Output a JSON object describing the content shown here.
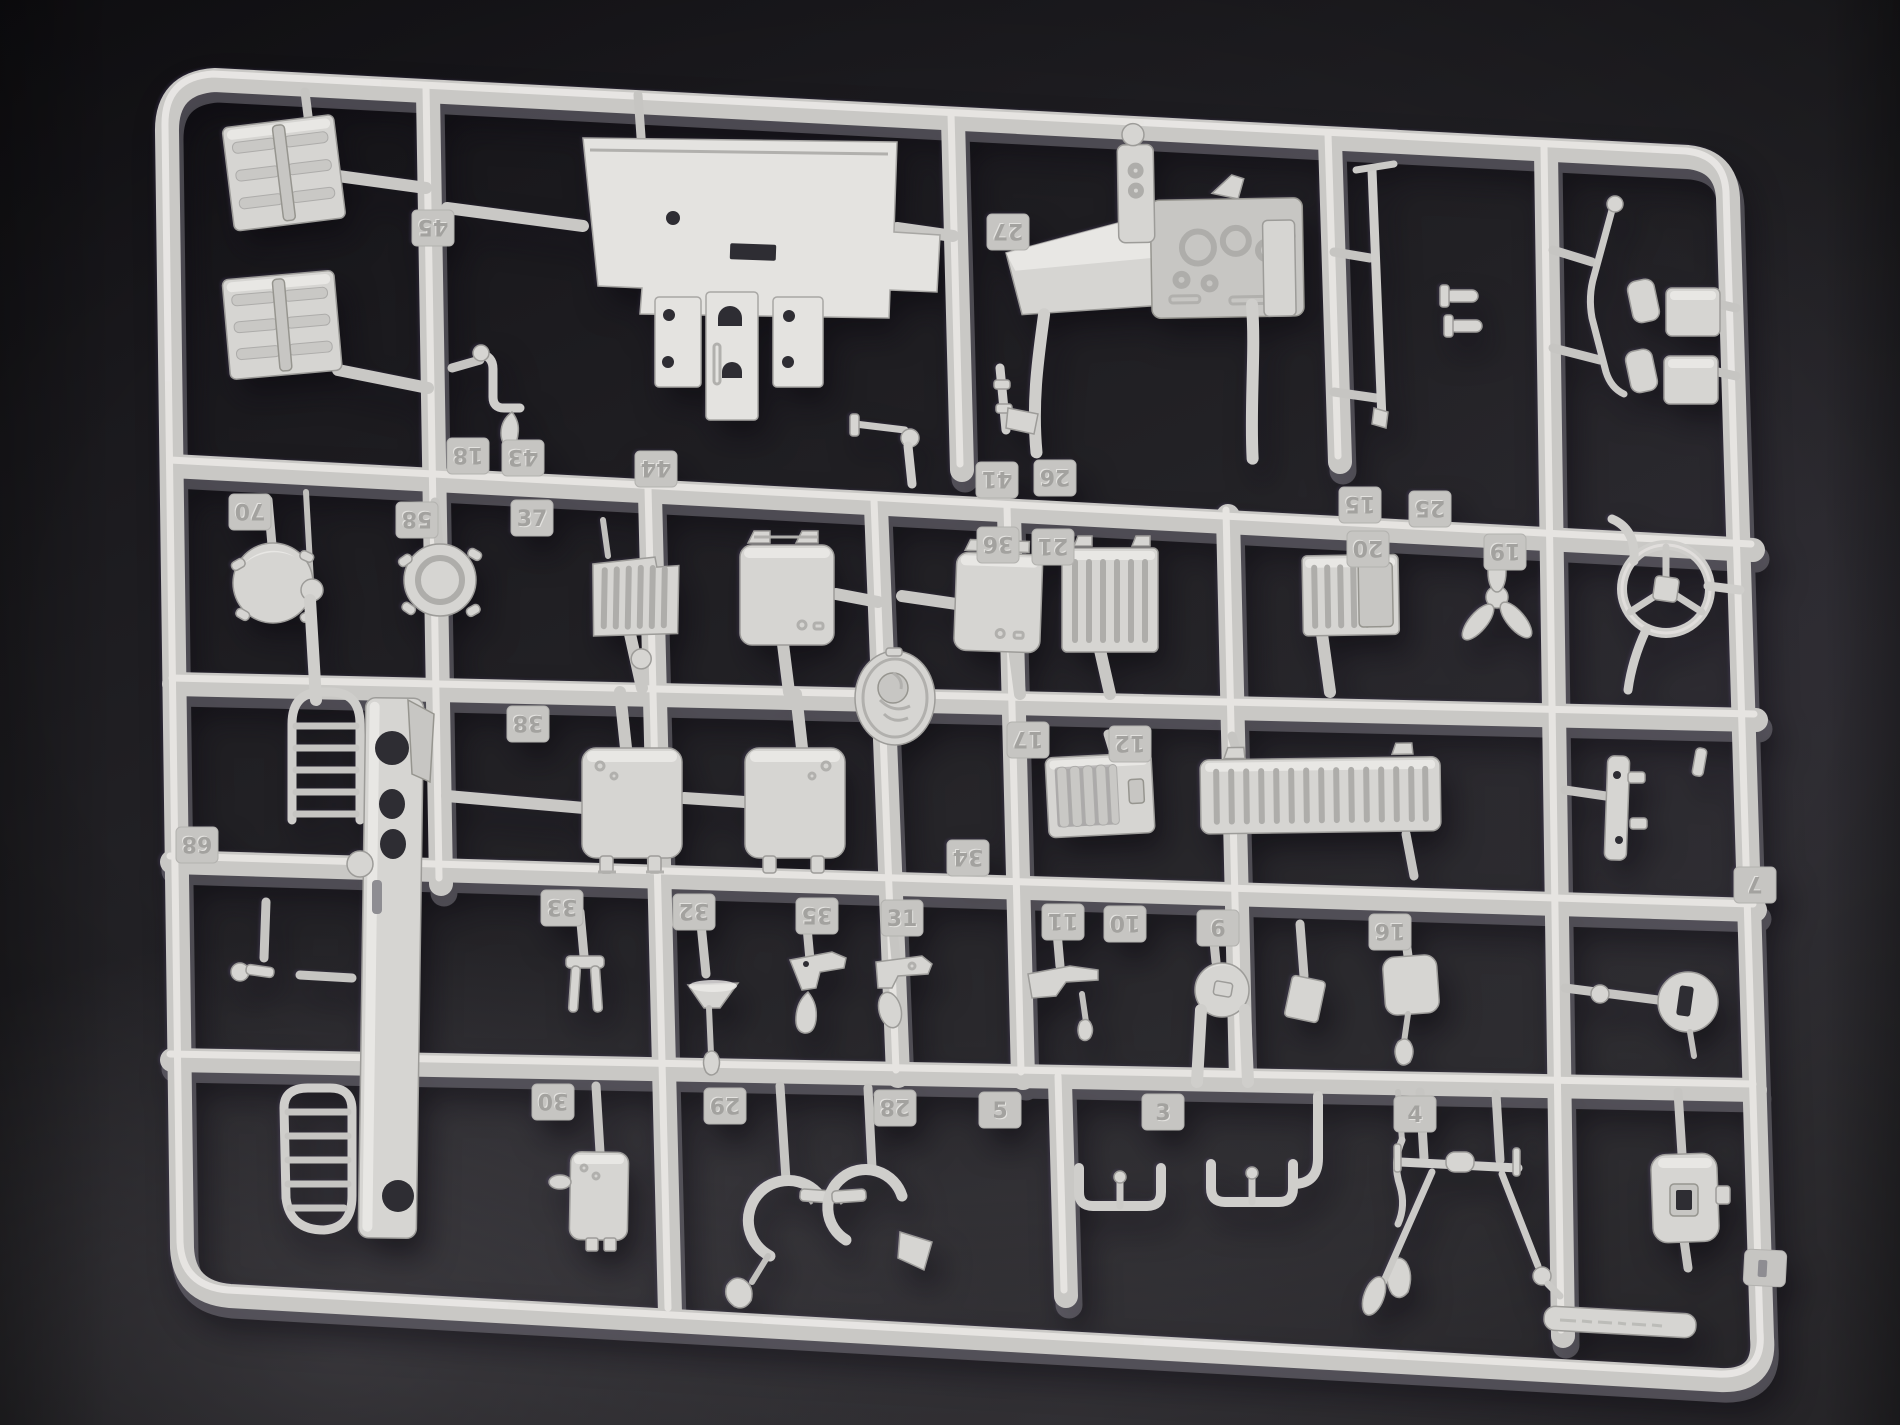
{
  "colors": {
    "background_dark": "#1d1c20",
    "background_light": "#3a383d",
    "plastic_base": "#c9c8c5",
    "plastic_highlight": "#eceae7",
    "plastic_shadow": "#807e86",
    "part_face": "#d6d5d2",
    "tag_face": "#c6c5c2",
    "hole_dark": "#2e2d33"
  },
  "sprue": {
    "material_color_name": "light-gray plastic",
    "part_number_tags": [
      {
        "label": "45",
        "x": 433,
        "y": 228,
        "rotated": true
      },
      {
        "label": "27",
        "x": 1008,
        "y": 232,
        "rotated": true
      },
      {
        "label": "18",
        "x": 468,
        "y": 456,
        "rotated": true
      },
      {
        "label": "43",
        "x": 523,
        "y": 458,
        "rotated": true
      },
      {
        "label": "44",
        "x": 656,
        "y": 469,
        "rotated": true
      },
      {
        "label": "41",
        "x": 997,
        "y": 480,
        "rotated": true
      },
      {
        "label": "26",
        "x": 1055,
        "y": 478,
        "rotated": true
      },
      {
        "label": "36",
        "x": 998,
        "y": 545,
        "rotated": true
      },
      {
        "label": "21",
        "x": 1053,
        "y": 547,
        "rotated": true
      },
      {
        "label": "15",
        "x": 1360,
        "y": 505,
        "rotated": true
      },
      {
        "label": "25",
        "x": 1430,
        "y": 509,
        "rotated": true
      },
      {
        "label": "20",
        "x": 1368,
        "y": 549,
        "rotated": true
      },
      {
        "label": "19",
        "x": 1505,
        "y": 552,
        "rotated": true
      },
      {
        "label": "70",
        "x": 250,
        "y": 512,
        "rotated": true
      },
      {
        "label": "58",
        "x": 417,
        "y": 520,
        "rotated": true
      },
      {
        "label": "37",
        "x": 532,
        "y": 518,
        "rotated": false
      },
      {
        "label": "38",
        "x": 528,
        "y": 724,
        "rotated": true
      },
      {
        "label": "17",
        "x": 1028,
        "y": 740,
        "rotated": true
      },
      {
        "label": "12",
        "x": 1130,
        "y": 744,
        "rotated": true
      },
      {
        "label": "68",
        "x": 197,
        "y": 845,
        "rotated": true
      },
      {
        "label": "34",
        "x": 968,
        "y": 858,
        "rotated": true
      },
      {
        "label": "33",
        "x": 562,
        "y": 908,
        "rotated": true
      },
      {
        "label": "32",
        "x": 694,
        "y": 912,
        "rotated": true
      },
      {
        "label": "35",
        "x": 817,
        "y": 916,
        "rotated": true
      },
      {
        "label": "31",
        "x": 902,
        "y": 918,
        "rotated": false
      },
      {
        "label": "11",
        "x": 1063,
        "y": 922,
        "rotated": true
      },
      {
        "label": "10",
        "x": 1125,
        "y": 924,
        "rotated": true
      },
      {
        "label": "9",
        "x": 1218,
        "y": 928,
        "rotated": true
      },
      {
        "label": "16",
        "x": 1390,
        "y": 932,
        "rotated": true
      },
      {
        "label": "7",
        "x": 1755,
        "y": 885,
        "rotated": true
      },
      {
        "label": "30",
        "x": 553,
        "y": 1102,
        "rotated": true
      },
      {
        "label": "29",
        "x": 725,
        "y": 1106,
        "rotated": true
      },
      {
        "label": "28",
        "x": 895,
        "y": 1108,
        "rotated": true
      },
      {
        "label": "5",
        "x": 1000,
        "y": 1110,
        "rotated": false
      },
      {
        "label": "3",
        "x": 1163,
        "y": 1112,
        "rotated": false
      },
      {
        "label": "4",
        "x": 1415,
        "y": 1114,
        "rotated": false
      }
    ],
    "part_shapes": [
      "stowage-grille-panel",
      "stowage-grille-panel",
      "cab-floor-panel",
      "seat-base-block",
      "seat-back-block",
      "seat-block",
      "dashboard-cowl",
      "signal-pole",
      "rear-view-mirror",
      "rear-view-mirror",
      "gear-lever-rod",
      "dome-light",
      "filler-cap",
      "radiator-grille",
      "engine-hatch",
      "engine-hatch",
      "radiator-grille",
      "radiator-grille",
      "cooling-fan",
      "steering-wheel",
      "oval-emblem",
      "fuel-tank",
      "fuel-tank",
      "louver-vent-panel",
      "slatted-vent-panel",
      "chassis-rail-with-grilles",
      "tow-fork",
      "funnel-horn",
      "control-lever",
      "pedal-lever",
      "latch-hook",
      "signal-knob",
      "small-box",
      "mirror-plate",
      "slotted-disc",
      "hinge-bracket",
      "stowage-box",
      "spring-clamp",
      "spring-clamp",
      "u-bracket",
      "u-bracket",
      "teardrop-pendant",
      "wiper-arm",
      "wiper-arm",
      "access-plate",
      "corner-tab"
    ]
  }
}
